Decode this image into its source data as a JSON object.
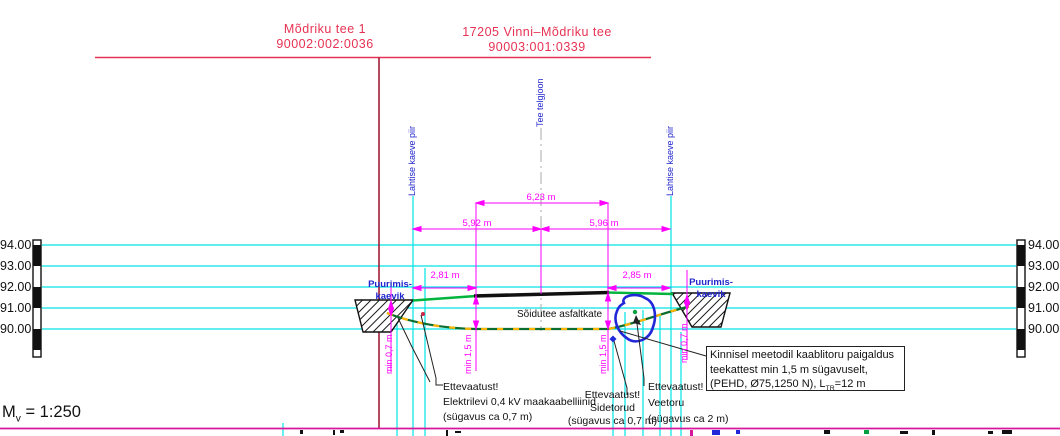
{
  "titles": {
    "left_property": {
      "line1": "Mõdriku tee 1",
      "line2": "90002:002:0036"
    },
    "road": {
      "line1": "17205 Vinni–Mõdriku tee",
      "line2": "90003:001:0339"
    }
  },
  "axis": {
    "levels": [
      "94.00",
      "93.00",
      "92.00",
      "91.00",
      "90.00"
    ]
  },
  "scale": {
    "prefix": "M",
    "sub": "v",
    "value": " = 1:250"
  },
  "vertical_labels": {
    "excavation_boundary": "Lahtise kaeve piir",
    "road_centerline": "Tee telgjoon"
  },
  "drill_pit": {
    "line1": "Puurimis-",
    "line2": "kaevik"
  },
  "dimensions": {
    "total": "6,23 m",
    "left_half": "5,92 m",
    "right_half": "5,96 m",
    "left_edge": "2,81 m",
    "right_edge": "2,85 m",
    "min_cover": "min 1,5 m",
    "min_depth": "min 0,7 m"
  },
  "road_surface_label": "Sõidutee asfaltkate",
  "callouts": {
    "electric": {
      "line1": "Ettevaatust!",
      "line2": "Elektrilevi 0,4 kV maakaabelliinid",
      "line3": "(sügavus ca 0,7 m)"
    },
    "telecom": {
      "line1": "Ettevaatust!",
      "line2": "Sidetorud",
      "line3": "(sügavus ca 0,7 m)"
    },
    "water": {
      "line1": "Ettevaatust!",
      "line2": "Veetoru",
      "line3": "(sügavus ca 2 m)"
    }
  },
  "note_box": {
    "line1": "Kinnisel meetodil kaablitoru paigaldus",
    "line2": "teekattest min 1,5 m sügavuselt,",
    "line3_pre": "(PEHD, Ø75,1250 N), L",
    "line3_sub": "TR",
    "line3_post": "=12 m"
  },
  "colors": {
    "title_red": "#e73253",
    "boundary_dark_red": "#a21c38",
    "dimension_magenta": "#ff00ff",
    "grid_cyan": "#00e4e4",
    "label_blue": "#2025cc",
    "road_green": "#00b43c",
    "cable_green": "#0c6e2e",
    "cable_dash_orange": "#ffb400",
    "pipe_blue": "#2228d8"
  }
}
